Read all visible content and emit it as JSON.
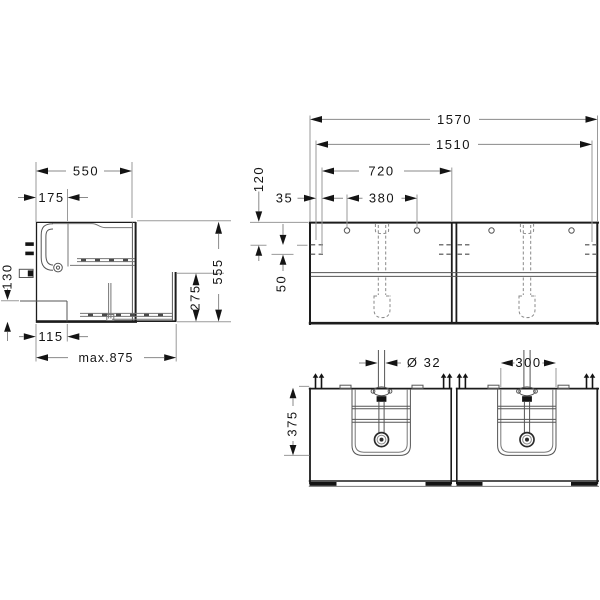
{
  "colors": {
    "background": "#ffffff",
    "object_line": "#1c1c1c",
    "detail_line": "#555555",
    "dimension_line": "#9a9a9a",
    "text": "#141414"
  },
  "side_view": {
    "depth": "550",
    "top_setback": "175",
    "connection_height": "130",
    "recess_depth": "115",
    "max_depth_open": "max.875",
    "drawer_front_height": "275",
    "height": "555"
  },
  "front_view": {
    "overall_width": "1570",
    "inner_width": "1510",
    "section_width": "720",
    "faucet_hole_spacing": "380",
    "side_offset": "35",
    "top_offset": "120",
    "row_spacing": "50"
  },
  "bottom_view": {
    "drain_diameter": "Ø 32",
    "basin_cutout_width": "300",
    "basin_depth": "375"
  }
}
